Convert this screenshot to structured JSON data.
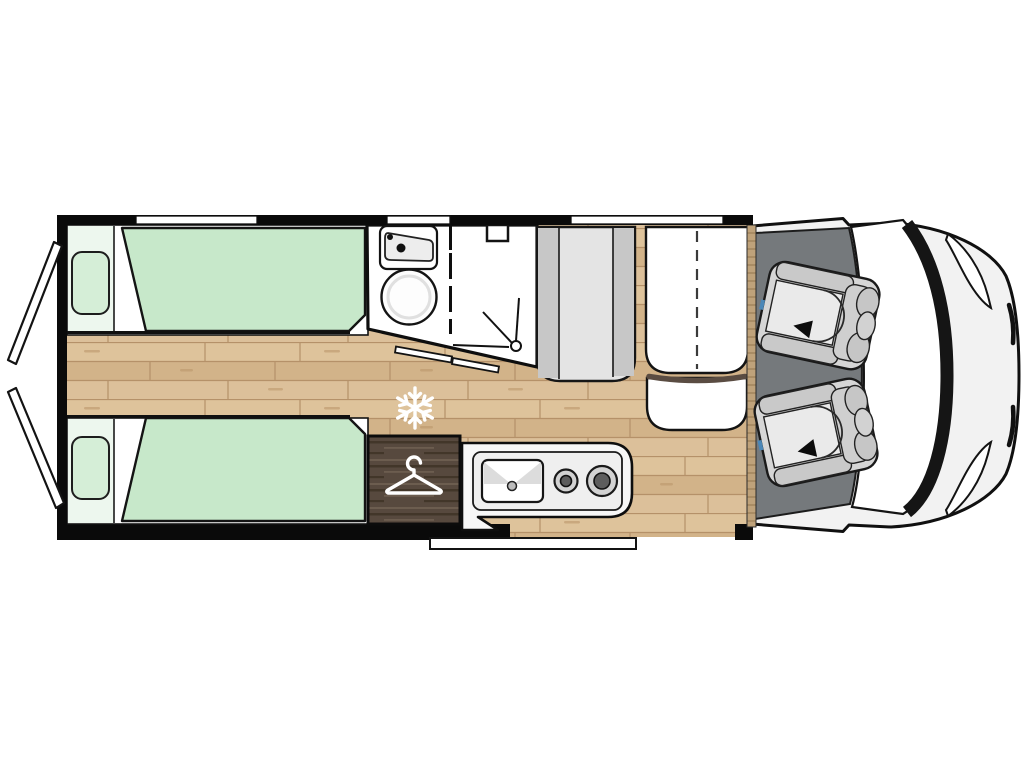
{
  "diagram": {
    "type": "motorhome-floorplan",
    "view": "top-down"
  },
  "palette": {
    "wall": "#0a0a0a",
    "floor-a": "#dec39b",
    "floor-b": "#d2b389",
    "floor-c": "#dcc09a",
    "floor-line": "#b59169",
    "mattress": "#c7e8ca",
    "pillow": "#d5eed7",
    "bed-head": "#edf7ee",
    "bench-light": "#e4e4e4",
    "bench-dark": "#c7c7c7",
    "cab-floor": "#75797c",
    "vehicle-body": "#f2f2f2",
    "wardrobe": "#57493e",
    "wardrobe-dark": "#423629",
    "wardrobe-light": "#6c5d4f",
    "trim": "#5a4c42",
    "snow": "#ffffff",
    "seatbelt-blue": "#4a87b8"
  },
  "areas": {
    "rear_doors": {
      "icon": "rear-door-panels",
      "count": 2
    },
    "bedroom": {
      "icon": "twin-beds",
      "beds": 2,
      "pillows": 2,
      "windows": 1
    },
    "bathroom": {
      "icons": [
        "washbasin-icon",
        "faucet-dots-icon",
        "toilet-bowl-icon",
        "shower-head-icon",
        "roof-vent-icon",
        "folding-door-dashed-line"
      ]
    },
    "fridge": {
      "icon": "snowflake-icon"
    },
    "wardrobe": {
      "icon": "hanger-icon"
    },
    "kitchen": {
      "icons": [
        "kitchen-sink-icon",
        "burner-small-icon",
        "burner-large-icon"
      ]
    },
    "dinette": {
      "icons": [
        "bench-seat",
        "folding-table-dashed-line",
        "stool-seat"
      ],
      "windows": 1
    },
    "cab": {
      "icon": "swivel-seat-rotation-arrow",
      "seats": 2,
      "features": [
        "windshield",
        "headlight-left",
        "headlight-right"
      ]
    },
    "entry": {
      "icon": "entry-step-bar"
    }
  }
}
